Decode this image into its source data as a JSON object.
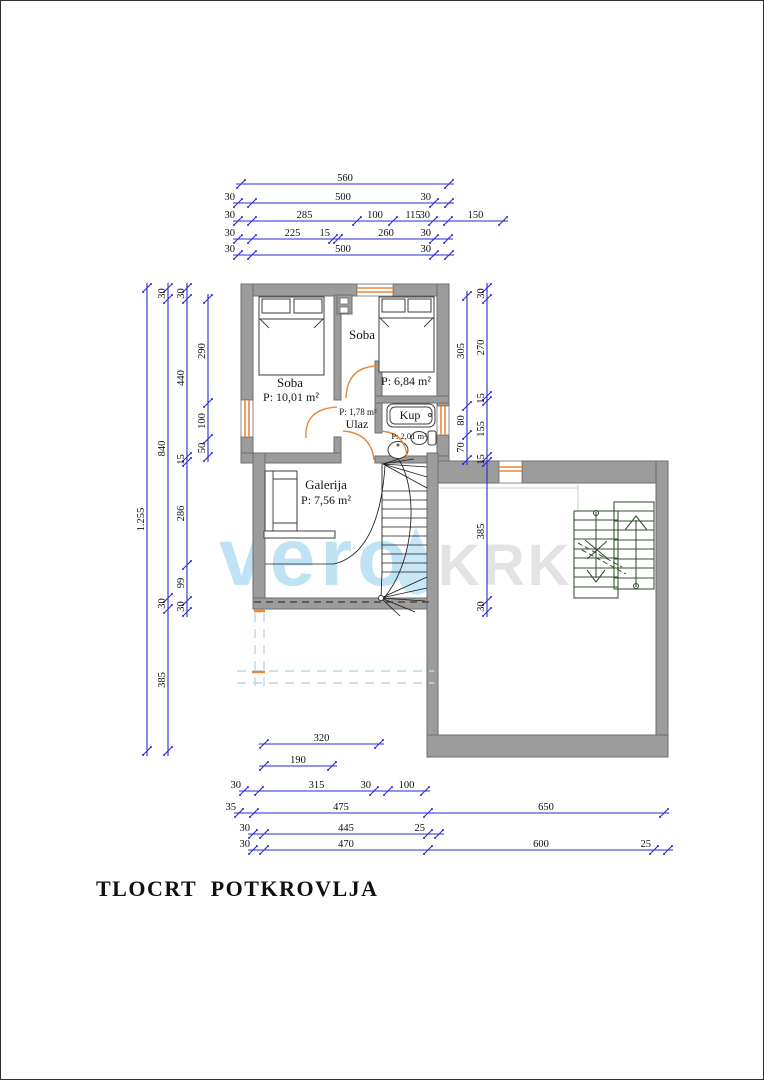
{
  "title": "TLOCRT  POTKROVLJA",
  "watermark": {
    "left": "vero",
    "right": "KRK"
  },
  "colors": {
    "dimension_blue": "#2a2ad0",
    "wall_gray": "#9c9c9c",
    "wall_edge": "#6e6e6e",
    "door_orange": "#e8883a",
    "stair_green": "#35502f",
    "wm_blue": "#bfe2f4",
    "wm_gray": "#e3e3e3",
    "dash_blue": "#b9d8e8"
  },
  "rooms": {
    "soba1": {
      "name": "Soba",
      "area": "P: 10,01 m²"
    },
    "soba2": {
      "name": "Soba",
      "area": "P: 6,84 m²"
    },
    "ulaz": {
      "name": "Ulaz",
      "area": "P: 1,78 m²"
    },
    "kup": {
      "name": "Kup",
      "area": "P: 2,01 m²"
    },
    "galerija": {
      "name": "Galerija",
      "area": "P: 7,56 m²"
    }
  },
  "dimensions": [
    {
      "o": "h",
      "pos": 183,
      "stops": [
        240,
        448
      ],
      "labels": [
        "560"
      ]
    },
    {
      "o": "h",
      "pos": 202,
      "stops": [
        237,
        251,
        433,
        448
      ],
      "labels": [
        "30",
        "500",
        "30"
      ]
    },
    {
      "o": "h",
      "pos": 220,
      "stops": [
        237,
        251,
        356,
        392,
        432,
        447,
        502
      ],
      "labels": [
        "30",
        "285",
        "100",
        "115",
        "30",
        "150"
      ]
    },
    {
      "o": "h",
      "pos": 238,
      "stops": [
        237,
        251,
        332,
        337,
        433,
        447
      ],
      "labels": [
        "30",
        "225",
        "15",
        "260",
        "30"
      ]
    },
    {
      "o": "h",
      "pos": 254,
      "stops": [
        237,
        251,
        433,
        448
      ],
      "labels": [
        "30",
        "500",
        "30"
      ]
    },
    {
      "o": "h",
      "pos": 743,
      "stops": [
        263,
        378
      ],
      "labels": [
        "320"
      ]
    },
    {
      "o": "h",
      "pos": 765,
      "stops": [
        263,
        331
      ],
      "labels": [
        "190"
      ]
    },
    {
      "o": "h",
      "pos": 790,
      "stops": [
        243,
        258,
        373,
        387,
        424
      ],
      "labels": [
        "30",
        "315",
        "30",
        "100"
      ]
    },
    {
      "o": "h",
      "pos": 812,
      "stops": [
        238,
        253,
        427,
        663
      ],
      "labels": [
        "35",
        "475",
        "650"
      ]
    },
    {
      "o": "h",
      "pos": 833,
      "stops": [
        252,
        263,
        427,
        438
      ],
      "labels": [
        "30",
        "445",
        "25"
      ]
    },
    {
      "o": "h",
      "pos": 849,
      "stops": [
        252,
        263,
        427,
        653,
        667
      ],
      "labels": [
        "30",
        "470",
        "600",
        "25"
      ]
    },
    {
      "o": "v",
      "pos": 146,
      "stops": [
        287,
        750
      ],
      "labels": [
        "1.255"
      ]
    },
    {
      "o": "v",
      "pos": 167,
      "stops": [
        287,
        298,
        597,
        608,
        750
      ],
      "labels": [
        "30",
        "840",
        "30",
        "385"
      ]
    },
    {
      "o": "v",
      "pos": 186,
      "stops": [
        287,
        298,
        456,
        461,
        564,
        600,
        611
      ],
      "labels": [
        "30",
        "440",
        "15",
        "286",
        "99",
        "30"
      ]
    },
    {
      "o": "v",
      "pos": 207,
      "stops": [
        298,
        402,
        438,
        456
      ],
      "labels": [
        "290",
        "100",
        "50"
      ]
    },
    {
      "o": "v",
      "pos": 466,
      "stops": [
        295,
        405,
        434,
        459
      ],
      "labels": [
        "305",
        "80",
        "70"
      ]
    },
    {
      "o": "v",
      "pos": 486,
      "stops": [
        287,
        298,
        395,
        400,
        456,
        461,
        600,
        611
      ],
      "labels": [
        "30",
        "270",
        "15",
        "155",
        "15",
        "385",
        "30"
      ]
    }
  ]
}
